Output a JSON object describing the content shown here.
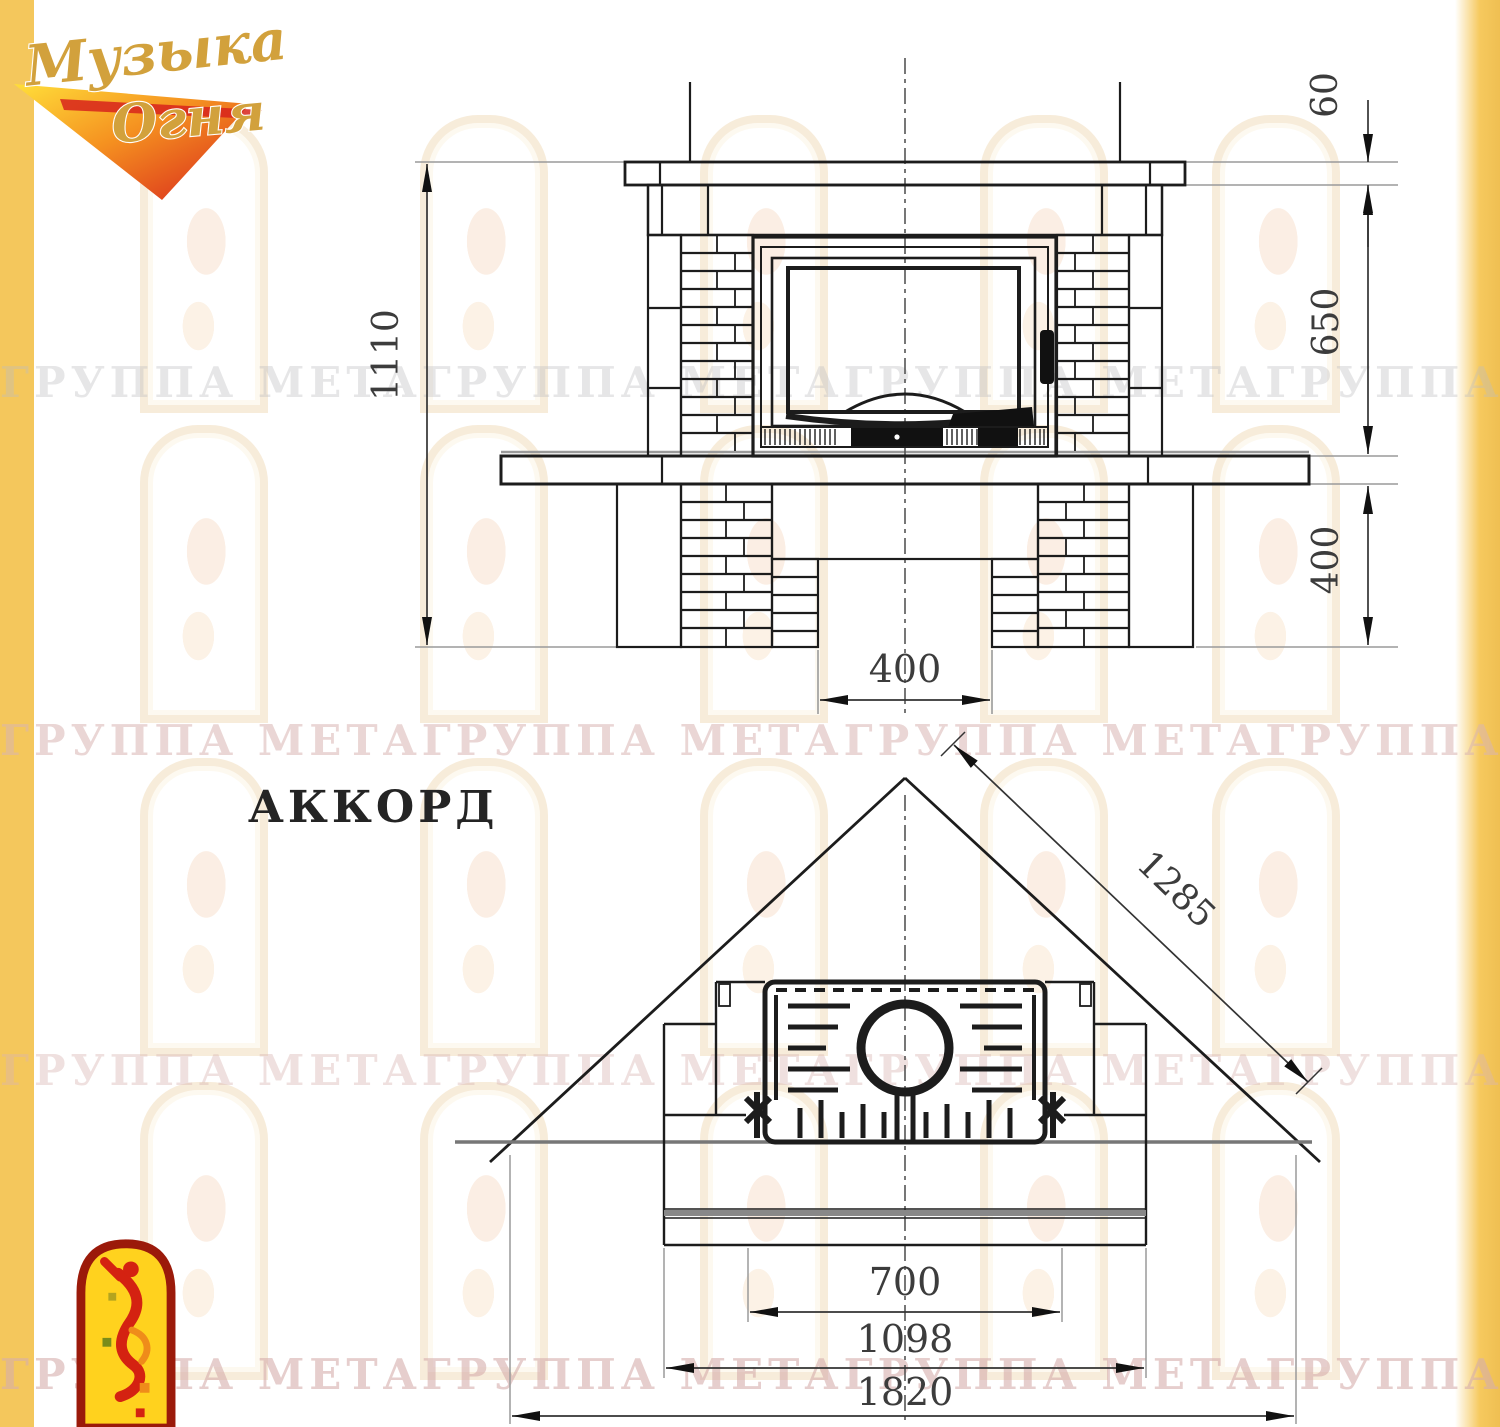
{
  "logo": {
    "line1": "Музыка",
    "line2": "Огня"
  },
  "model_name": "АККОРД",
  "watermark_text": "ГРУППА МЕТАГРУППА МЕТАГРУППА МЕТАГРУППА МЕТА",
  "front_view": {
    "dims": {
      "total_height": "1110",
      "shelf_thickness": "60",
      "middle_zone": "650",
      "base_zone": "400",
      "bottom_opening": "400"
    }
  },
  "plan_view": {
    "dims": {
      "diagonal": "1285",
      "opening": "700",
      "inner_width": "1098",
      "overall_width": "1820"
    }
  },
  "colors": {
    "accent_strip": "#f4c75c",
    "drawing_line": "#1c1c1c",
    "dim_text": "#3c3c3c",
    "logo_gold": "#d2a13c",
    "emblem_red": "#9b1a0a",
    "emblem_yellow": "#ffd21e"
  }
}
